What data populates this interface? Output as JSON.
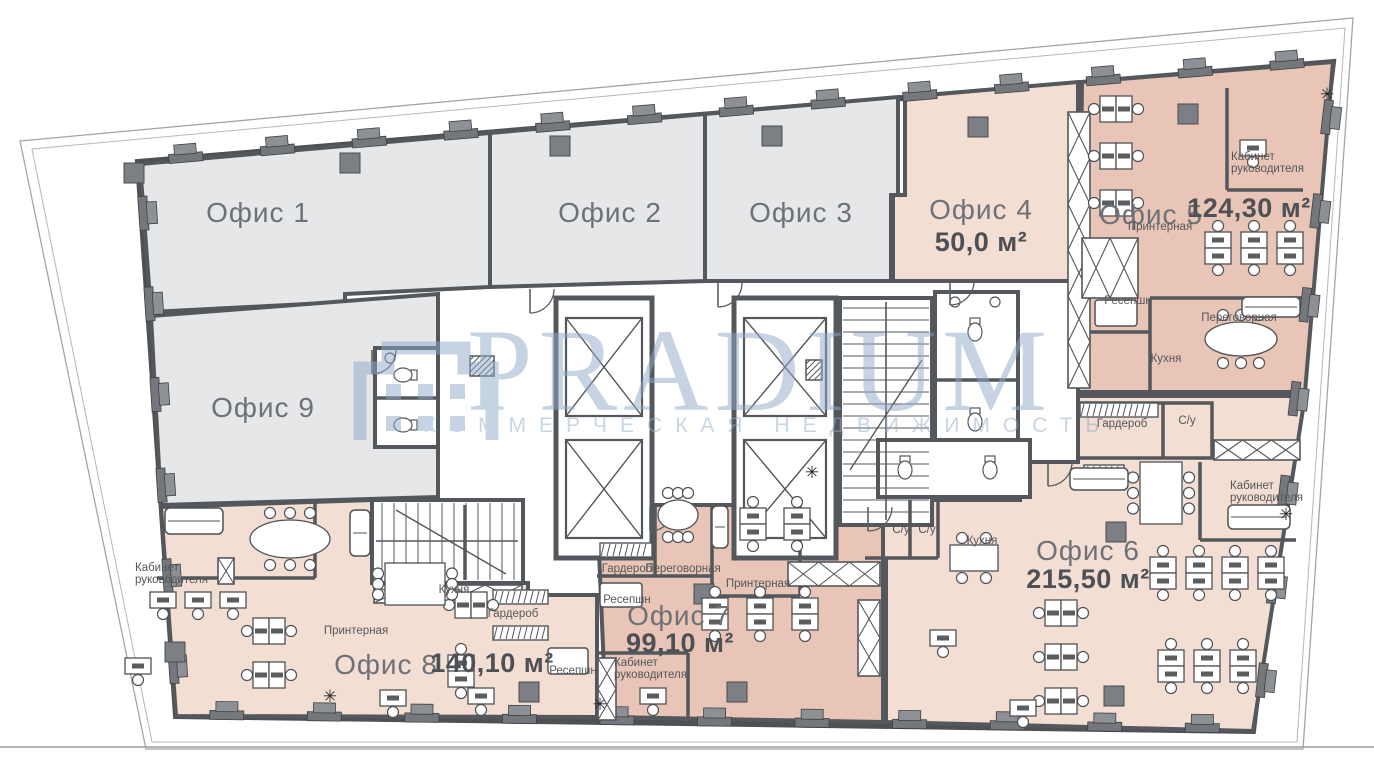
{
  "watermark": {
    "brand": "PRADIUM",
    "tagline": "КОММЕРЧЕСКАЯ НЕДВИЖИМОСТЬ"
  },
  "palette": {
    "wall": "#54575b",
    "office_grey": "#e6e7e8",
    "office_pink_light": "#f3ded3",
    "office_pink_dark": "#e8c5b6",
    "watermark_blue": "#8fa9c9",
    "label_grey": "#6e7175",
    "area_dark": "#4d5054"
  },
  "offices": [
    {
      "name": "Офис 1",
      "area": ""
    },
    {
      "name": "Офис 2",
      "area": ""
    },
    {
      "name": "Офис 3",
      "area": ""
    },
    {
      "name": "Офис 4",
      "area": "50,0 м²"
    },
    {
      "name": "Офис 5",
      "area": "124,30 м²"
    },
    {
      "name": "Офис 6",
      "area": "215,50 м²"
    },
    {
      "name": "Офис 7",
      "area": "99,10 м²"
    },
    {
      "name": "Офис 8",
      "area": "140,10 м²"
    },
    {
      "name": "Офис 9",
      "area": ""
    }
  ],
  "room_types": {
    "cabinet_line1": "Кабинет",
    "cabinet_line2": "руководителя",
    "printer": "Принтерная",
    "reception": "Ресепшн",
    "kitchen": "Кухня",
    "meeting": "Переговорная",
    "wardrobe": "Гардероб",
    "wc": "С/у"
  }
}
